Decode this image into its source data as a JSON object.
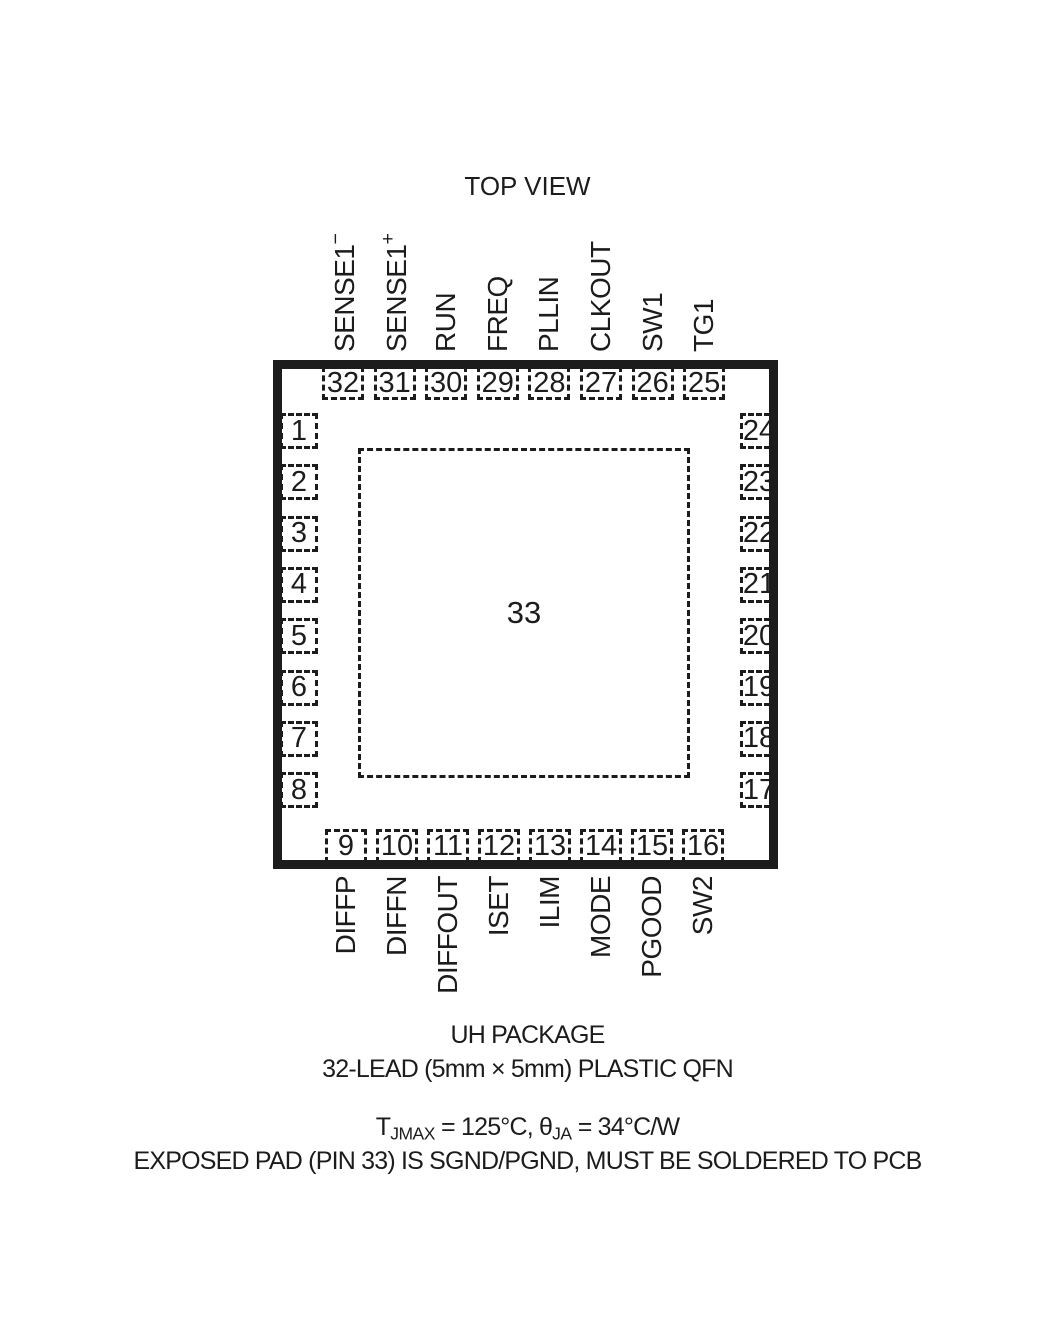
{
  "title": "TOP VIEW",
  "colors": {
    "ink": "#1c1c1c",
    "background": "#ffffff"
  },
  "package": {
    "center_pad_number": "33",
    "pins": {
      "top": [
        {
          "number": "32",
          "label": "SENSE1^−^"
        },
        {
          "number": "31",
          "label": "SENSE1^+^"
        },
        {
          "number": "30",
          "label": "RUN"
        },
        {
          "number": "29",
          "label": "FREQ"
        },
        {
          "number": "28",
          "label": "PLLIN"
        },
        {
          "number": "27",
          "label": "CLKOUT"
        },
        {
          "number": "26",
          "label": "SW1"
        },
        {
          "number": "25",
          "label": "TG1"
        }
      ],
      "left": [
        {
          "number": "1",
          "label": "TK/SS"
        },
        {
          "number": "2",
          "label": "V~FB~"
        },
        {
          "number": "3",
          "label": "I~TH~"
        },
        {
          "number": "4",
          "label": "AVP"
        },
        {
          "number": "5",
          "label": "ITEMP"
        },
        {
          "number": "6",
          "label": "PHASMD"
        },
        {
          "number": "7",
          "label": "SENSE2^+^"
        },
        {
          "number": "8",
          "label": "SENSE2^−^"
        }
      ],
      "right": [
        {
          "number": "24",
          "label": "BOOST1"
        },
        {
          "number": "23",
          "label": "BG1"
        },
        {
          "number": "22",
          "label": "V~IN~"
        },
        {
          "number": "21",
          "label": "INTV~CC~"
        },
        {
          "number": "20",
          "label": "EXTV~CC~"
        },
        {
          "number": "19",
          "label": "BG2"
        },
        {
          "number": "18",
          "label": "BOOST2"
        },
        {
          "number": "17",
          "label": "TG2"
        }
      ],
      "bottom": [
        {
          "number": "9",
          "label": "DIFFP"
        },
        {
          "number": "10",
          "label": "DIFFN"
        },
        {
          "number": "11",
          "label": "DIFFOUT"
        },
        {
          "number": "12",
          "label": "ISET"
        },
        {
          "number": "13",
          "label": "ILIM"
        },
        {
          "number": "14",
          "label": "MODE"
        },
        {
          "number": "15",
          "label": "PGOOD"
        },
        {
          "number": "16",
          "label": "SW2"
        }
      ]
    }
  },
  "footer": {
    "package_name": "UH PACKAGE",
    "package_desc": "32-LEAD (5mm × 5mm) PLASTIC QFN",
    "thermal_note": "T~JMAX~ = 125°C, θ~JA~ = 34°C/W",
    "exposed_pad_note": "EXPOSED PAD (PIN 33) IS SGND/PGND, MUST BE SOLDERED TO PCB"
  }
}
